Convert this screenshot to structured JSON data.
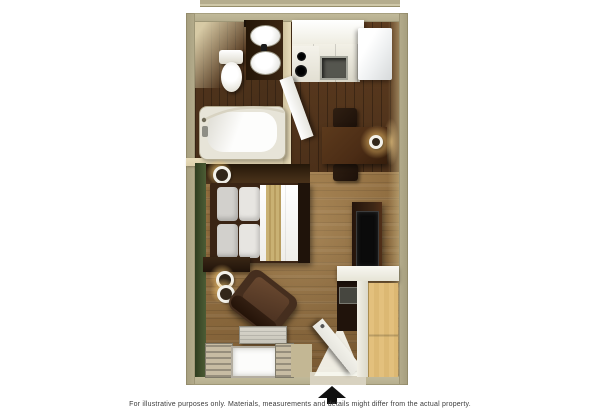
{
  "footer": {
    "disclaimer": "For illustrative purposes only.  Materials, measurements and details might differ from the actual property.",
    "entrance_arrow_icon": "arrow-up"
  },
  "floorplan": {
    "type": "studio-suite-floor-plan",
    "rooms": [
      "bathroom",
      "kitchen",
      "dining-area",
      "sleeping-area",
      "lounge-area",
      "entry"
    ]
  },
  "colors": {
    "canvas_bg": "#ffffff",
    "outer_wall": "#b5ad8d",
    "inner_wall": "#ddd0ac",
    "green_wall": "#42512d",
    "living_floor": "#8c6a3e",
    "kitchen_floor": "#4c3019",
    "bath_floor": "#432c18",
    "counter_white": "#efede4",
    "fridge_white": "#eef0f1",
    "dark_wood": "#3a2414",
    "table_wood": "#4b2c15",
    "tv_black": "#0b0b0b",
    "bed_white": "#efeee9",
    "pillow_gray": "#d2d0cc",
    "runner_tan": "#c9b173",
    "cabinet_tan": "#dcb873",
    "armchair_brown": "#452e1e",
    "door_white": "#e6e5de",
    "curtain_tan": "#c7bca3",
    "window_white": "#fcfcfb",
    "ac_gray": "#c8c5ba",
    "sconce_glow": "#e8c474",
    "arrow_black": "#101010",
    "text_gray": "#3c3c3c"
  }
}
